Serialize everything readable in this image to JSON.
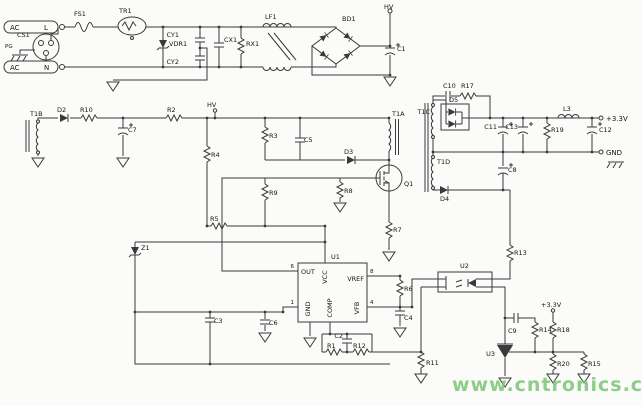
{
  "title": "Switching power supply schematic (+3.3V flyback converter)",
  "watermark": "www.cntronics.com",
  "colors": {
    "wire": "#3a3a3a",
    "label": "#141414",
    "watermark": "#7cc576",
    "bg": "#fbfbf9"
  },
  "labels": {
    "ac1_text": "AC",
    "ac1_pin": "L",
    "ac2_text": "AC",
    "ac2_pin": "N",
    "cs1": "CS1",
    "pg": "PG",
    "fs1": "FS1",
    "tr1": "TR1",
    "vdr1": "VDR1",
    "cy1": "CY1",
    "cy2": "CY2",
    "cx1": "CX1",
    "rx1": "RX1",
    "lf1": "LF1",
    "bd1": "BD1",
    "hv_top": "HV",
    "c1": "C1",
    "t1b": "T1B",
    "d2": "D2",
    "r10": "R10",
    "c7": "C7",
    "r2": "R2",
    "hv_mid": "HV",
    "r4": "R4",
    "r3": "R3",
    "c5": "C5",
    "d3": "D3",
    "t1a": "T1A",
    "q1": "Q1",
    "r9": "R9",
    "r8": "R8",
    "r5": "R5",
    "r7": "R7",
    "z1": "Z1",
    "u1": "U1",
    "pin_out": "OUT",
    "pin_vcc": "VCC",
    "pin_vref": "VREF",
    "pin_gnd": "GND",
    "pin_comp": "COMP",
    "pin_vfb": "VFB",
    "pin6": "6",
    "pin8": "8",
    "pin1": "1",
    "pin4": "4",
    "c3": "C3",
    "c6": "C6",
    "c2": "C2",
    "r1": "R1",
    "r12": "R12",
    "r6": "R6",
    "c4": "C4",
    "r11": "R11",
    "u2": "U2",
    "r13": "R13",
    "t1c": "T1C",
    "c10": "C10",
    "r17": "R17",
    "d5": "D5",
    "c11": "C11",
    "c13": "C13",
    "r19": "R19",
    "l3": "L3",
    "c12": "C12",
    "out_33": "+3.3V",
    "out_gnd": "GND",
    "t1d": "T1D",
    "c8": "C8",
    "d4": "D4",
    "u3": "U3",
    "c9": "C9",
    "r14": "R14",
    "r18": "R18",
    "rail_33": "+3.3V",
    "r20": "R20",
    "r15": "R15"
  }
}
